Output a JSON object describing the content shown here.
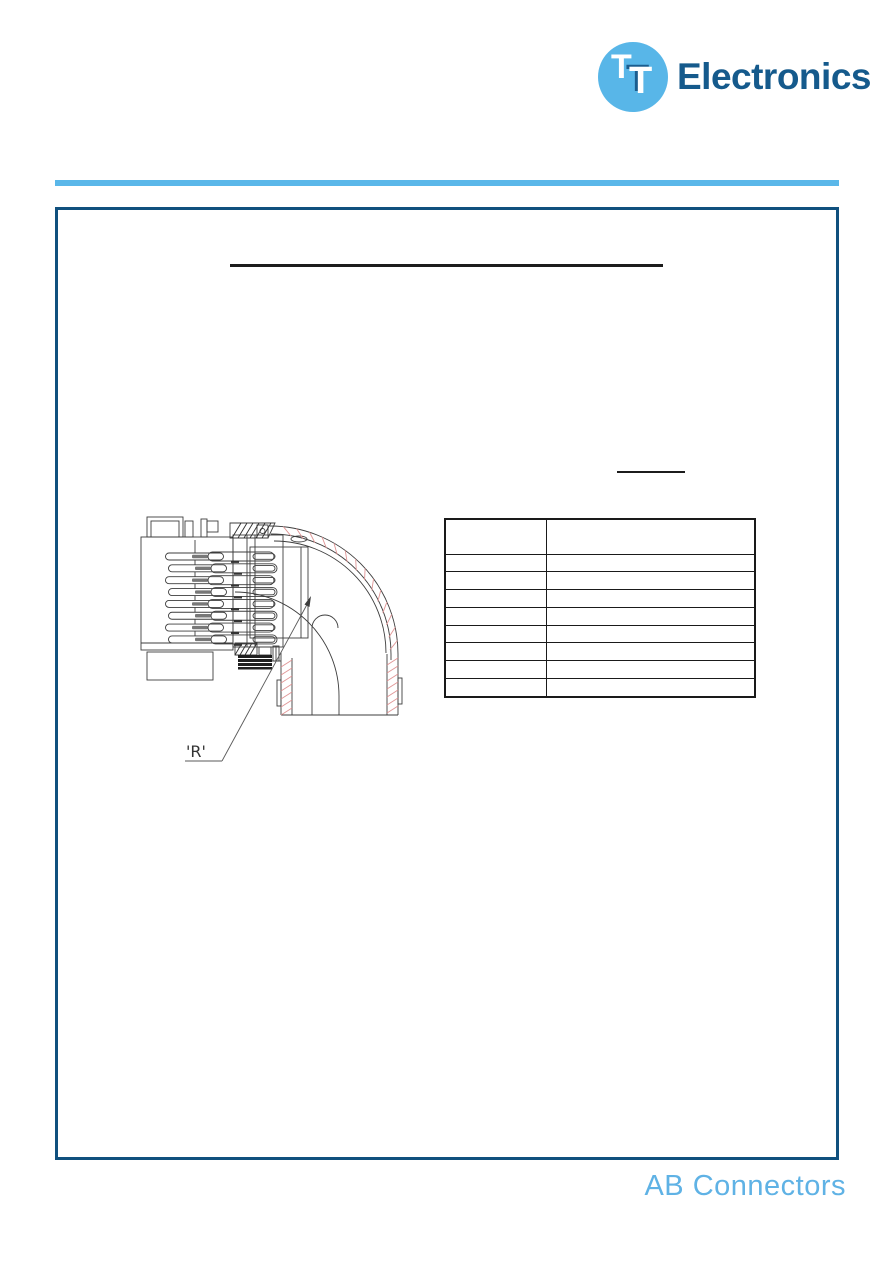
{
  "header": {
    "logo": {
      "mark_text_1": "T",
      "mark_text_2": "T",
      "brand_text": "Electronics",
      "circle_color": "#58b6e8",
      "brand_color": "#155a8c"
    },
    "divider_color": "#5ab7e9"
  },
  "content_box": {
    "border_color": "#10507e",
    "title_text": "",
    "section_heading_text": ""
  },
  "drawing": {
    "label_r": "'R'",
    "line_color": "#3d3d3d",
    "hatch_red": "#e09595",
    "hatch_black": "#2e2e2e"
  },
  "table": {
    "row_count": 9,
    "column_count": 2,
    "first_row_height": 33.5,
    "row_height": 17.8,
    "first_col_width": 100,
    "cells": [
      [
        "",
        ""
      ],
      [
        "",
        ""
      ],
      [
        "",
        ""
      ],
      [
        "",
        ""
      ],
      [
        "",
        ""
      ],
      [
        "",
        ""
      ],
      [
        "",
        ""
      ],
      [
        "",
        ""
      ],
      [
        "",
        ""
      ]
    ]
  },
  "footer": {
    "brand": "AB Connectors",
    "color": "#5fb2e5"
  }
}
